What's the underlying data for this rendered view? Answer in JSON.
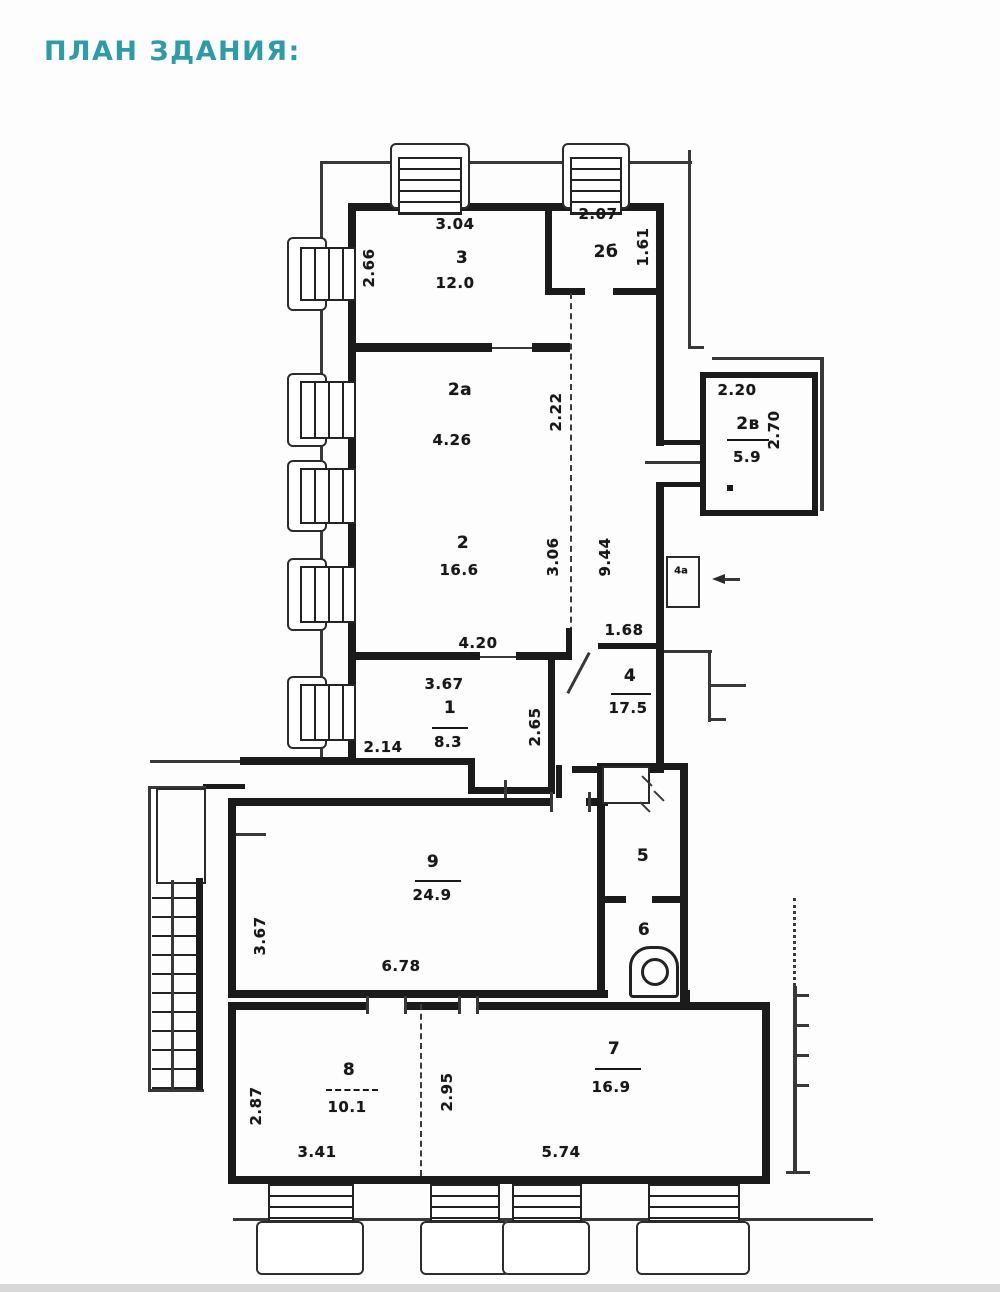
{
  "page": {
    "title": "ПЛАН ЗДАНИЯ:",
    "accent_color": "#2e9ba7"
  },
  "plan": {
    "rooms": [
      {
        "number": "3",
        "area": "12.0"
      },
      {
        "number": "2б"
      },
      {
        "number": "2а"
      },
      {
        "number": "2",
        "area": "16.6"
      },
      {
        "number": "2в",
        "area": "5.9"
      },
      {
        "number": "4",
        "area": "17.5"
      },
      {
        "number": "4а"
      },
      {
        "number": "1",
        "area": "8.3"
      },
      {
        "number": "9",
        "area": "24.9"
      },
      {
        "number": "5"
      },
      {
        "number": "6"
      },
      {
        "number": "8",
        "area": "10.1"
      },
      {
        "number": "7",
        "area": "16.9"
      }
    ],
    "dims": {
      "r3_top": "3.04",
      "r3_left": "2.66",
      "r2b_top": "2.07",
      "r2b_right": "1.61",
      "r2a_width": "4.26",
      "corridor_upper": "2.22",
      "r2_right": "3.06",
      "corridor_total": "9.44",
      "r2_bottom": "4.20",
      "r2v_top": "2.20",
      "r2v_right": "2.70",
      "r4_above": "1.68",
      "r1_top": "3.67",
      "r1_bottom_left": "2.14",
      "r1_right": "2.65",
      "r9_left": "3.67",
      "r9_bottom": "6.78",
      "r8_left": "2.87",
      "r8_bottom": "3.41",
      "divider_78": "2.95",
      "r7_bottom": "5.74"
    }
  }
}
